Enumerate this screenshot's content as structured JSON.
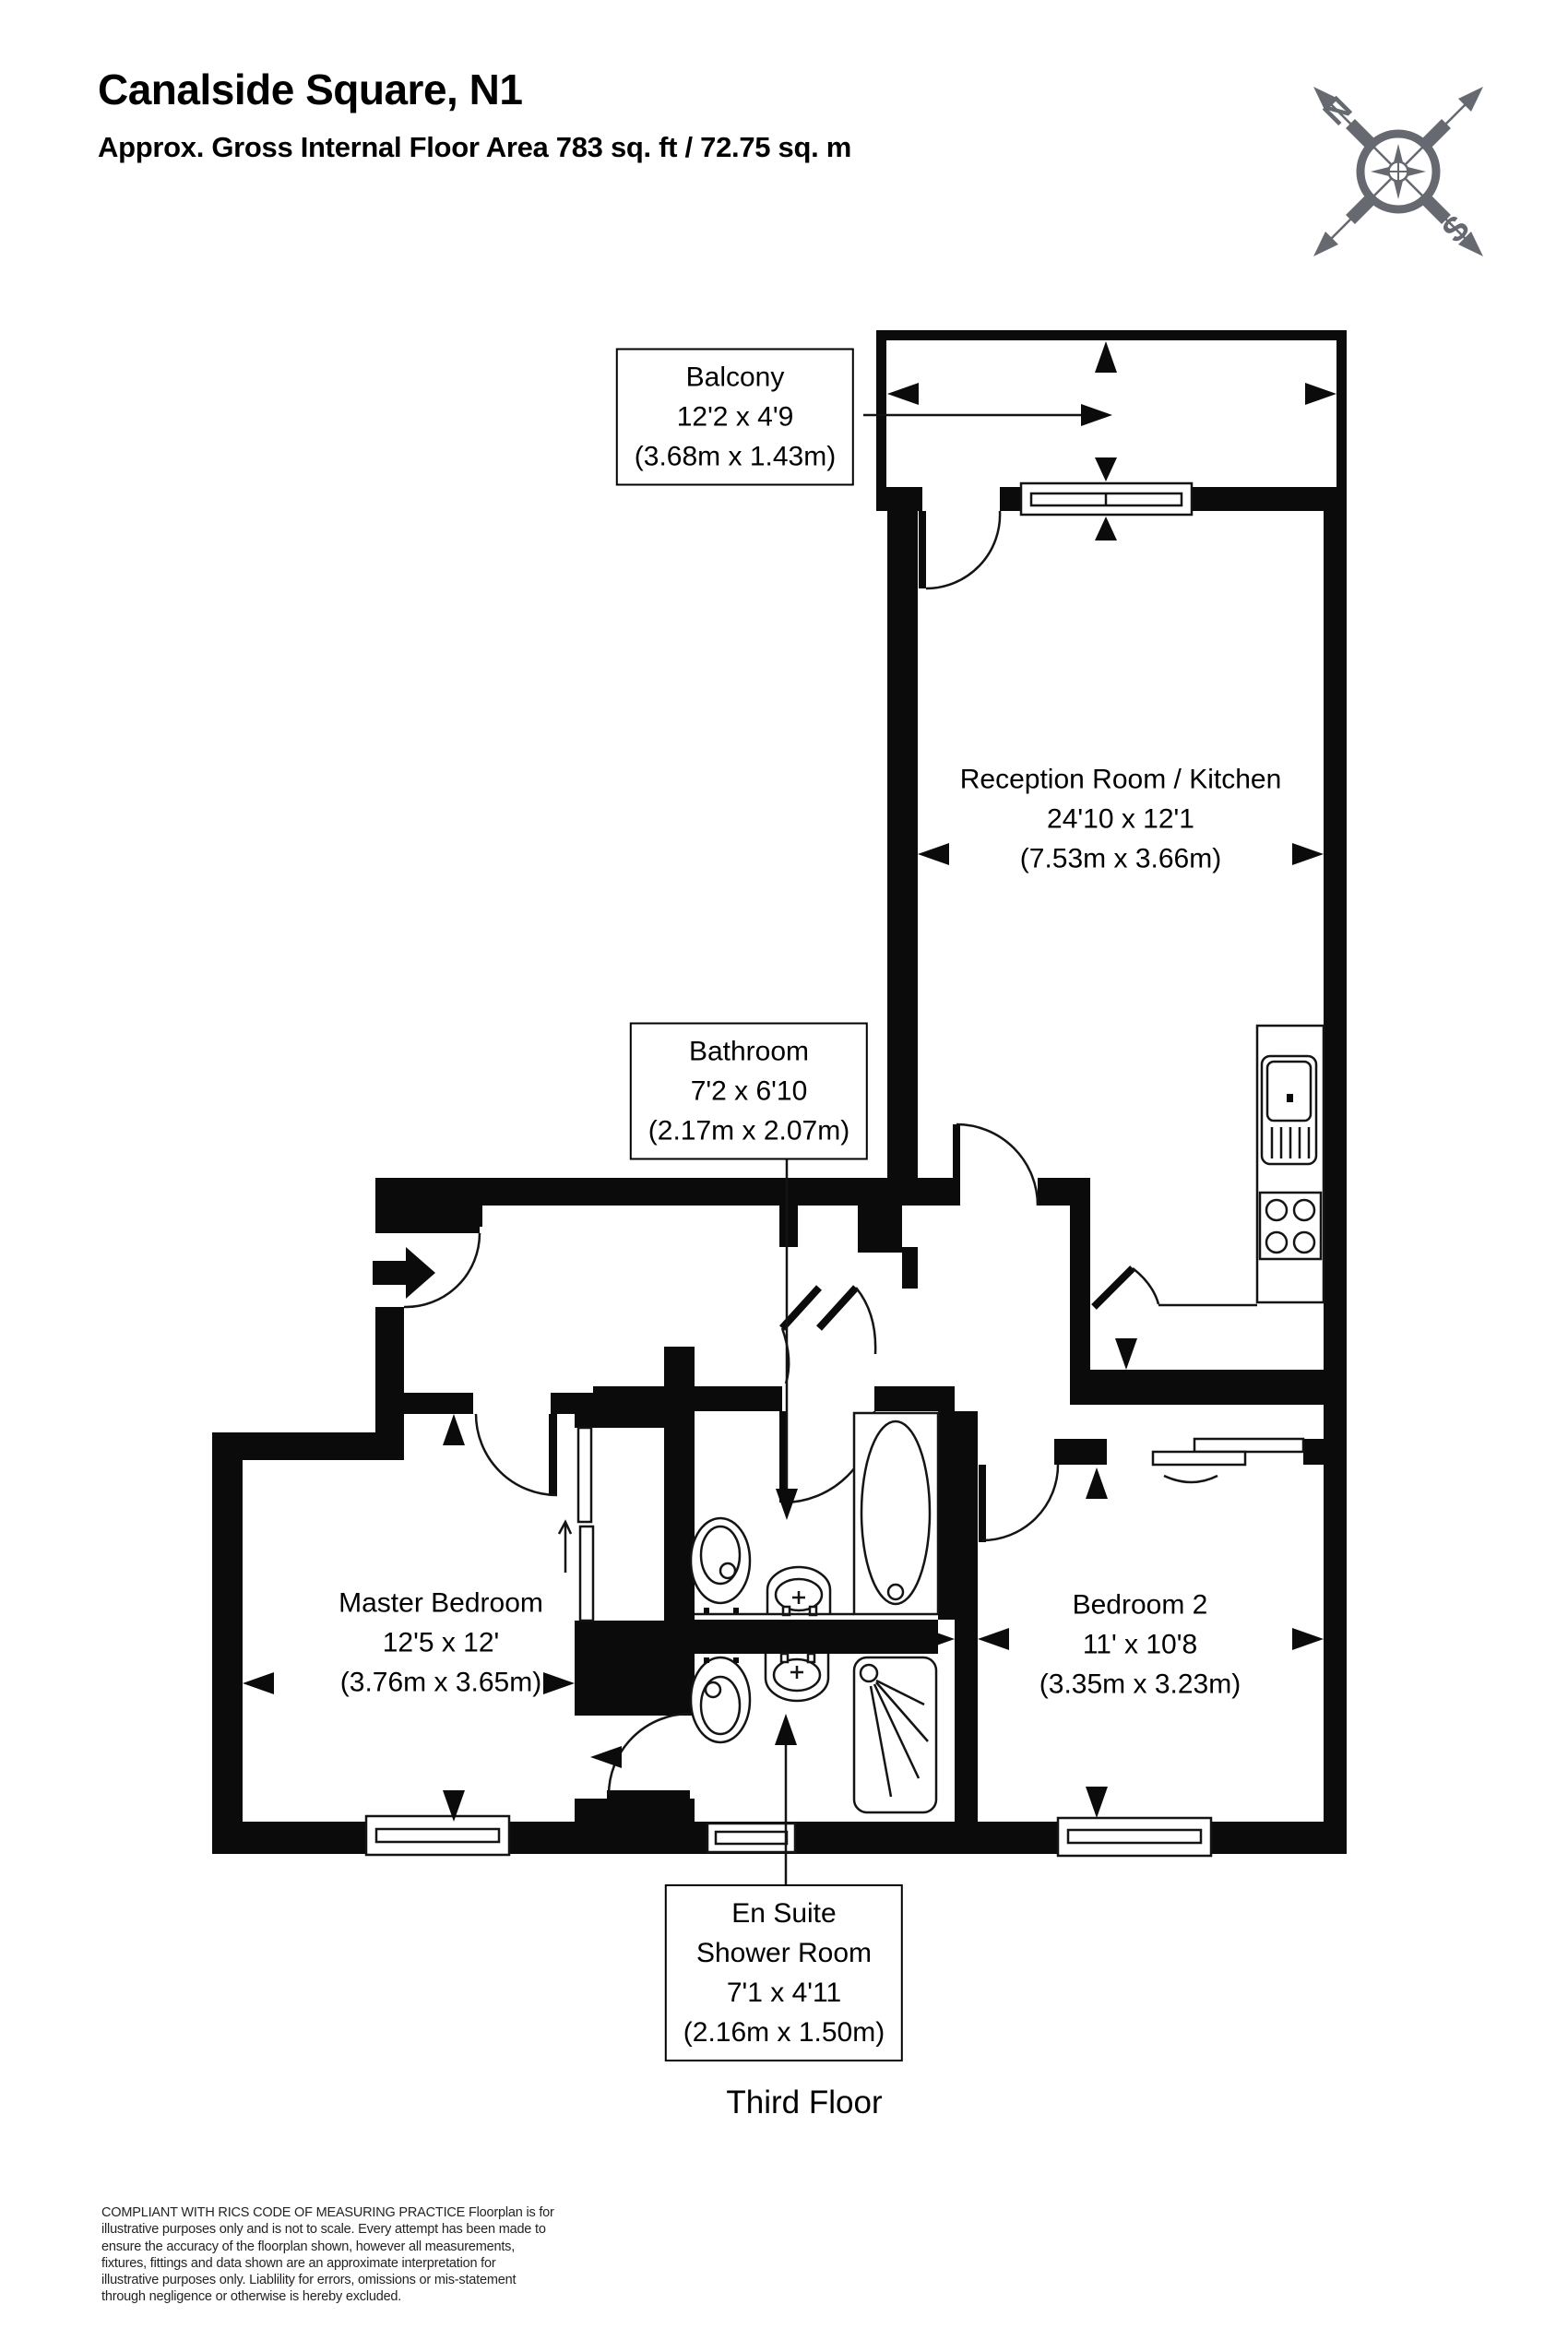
{
  "header": {
    "title": "Canalside Square, N1",
    "subtitle": "Approx. Gross Internal Floor Area 783 sq. ft / 72.75 sq. m"
  },
  "compass": {
    "north": "N",
    "south": "S"
  },
  "rooms": {
    "balcony": {
      "name": "Balcony",
      "imperial": "12'2 x 4'9",
      "metric": "(3.68m x 1.43m)"
    },
    "reception": {
      "name": "Reception Room / Kitchen",
      "imperial": "24'10 x 12'1",
      "metric": "(7.53m x 3.66m)"
    },
    "bathroom": {
      "name": "Bathroom",
      "imperial": "7'2 x 6'10",
      "metric": "(2.17m x 2.07m)"
    },
    "master_bedroom": {
      "name": "Master Bedroom",
      "imperial": "12'5 x 12'",
      "metric": "(3.76m x 3.65m)"
    },
    "bedroom2": {
      "name": "Bedroom 2",
      "imperial": "11' x 10'8",
      "metric": "(3.35m x 3.23m)"
    },
    "ensuite": {
      "name": "En Suite",
      "name2": "Shower Room",
      "imperial": "7'1 x 4'11",
      "metric": "(2.16m x 1.50m)"
    }
  },
  "floor": {
    "label": "Third Floor"
  },
  "disclaimer": "COMPLIANT WITH RICS CODE OF MEASURING PRACTICE  Floorplan is for illustrative purposes only and is not to scale. Every attempt has been made to ensure the accuracy of the floorplan shown, however all measurements, fixtures, fittings and data shown are an approximate interpretation for illustrative purposes only. Liablility for errors, omissions or mis-statement through negligence or otherwise is hereby excluded.",
  "colors": {
    "wall": "#0b0b0c",
    "line": "#141414",
    "compass": "#666a70",
    "text": "#000000"
  }
}
